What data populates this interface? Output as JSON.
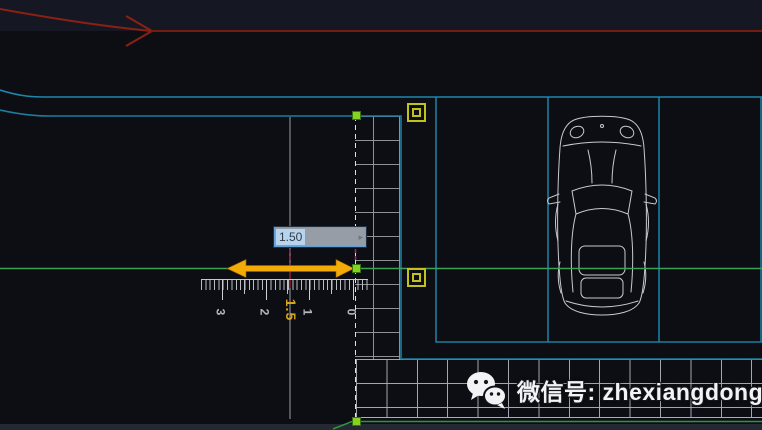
{
  "viewport": {
    "dynamic_input": {
      "value": "1.50",
      "arrow_glyph": "▸"
    },
    "dimension_label": "1.5",
    "ruler": {
      "labels": [
        "3",
        "2",
        "1",
        "0"
      ]
    },
    "watermark": {
      "icon": "wechat-icon",
      "text": "微信号: zhexiangdonghua"
    },
    "colors": {
      "background": "#0c0e13",
      "green_reference_line": "#3da258",
      "green_bottom_line": "#2f9440",
      "cyan_boundary": "#1f86ae",
      "red_path": "#8a2113",
      "measure_arrow_yellow": "#f5ab07",
      "grip_green": "#86d222",
      "marker_yellow": "#c2c21d",
      "selection_blue": "#b7d3ee",
      "crimson_trace": "#a12a5e"
    }
  }
}
